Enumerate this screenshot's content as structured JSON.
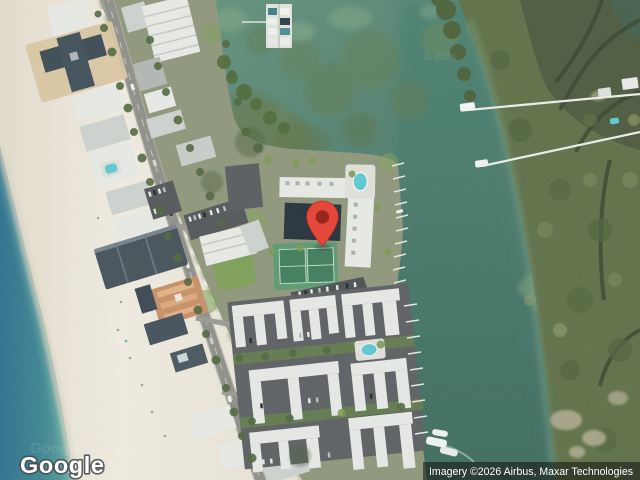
{
  "map": {
    "view_type": "satellite",
    "provider_logo": "Google",
    "attribution": "Imagery ©2026 Airbus, Maxar Technologies",
    "tile_watermark": "© 2026",
    "marker": {
      "label": "location-pin",
      "fill": "#E5473A",
      "core": "#99281C",
      "tip_x": 322,
      "tip_y": 246
    },
    "colors": {
      "gulf": "#2F7190",
      "gulf_shallow": "#5EA79E",
      "bay": "#6B9A84",
      "channel": "#3F6D60",
      "sand": "#EFEBE0",
      "island_ground": "#8F977B",
      "mangrove": "#5F7149",
      "road": "#97978E",
      "roof": "#E8EAE6",
      "tennis_court": "#417E5E",
      "pool": "#5FC8D2"
    }
  }
}
